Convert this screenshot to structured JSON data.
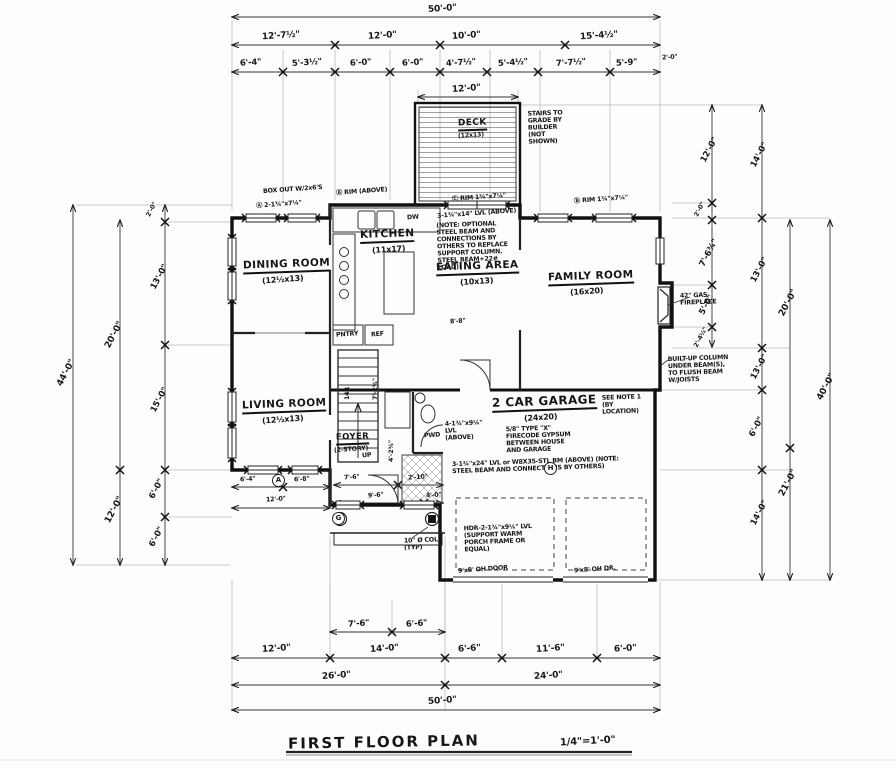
{
  "title": {
    "name": "FIRST FLOOR PLAN",
    "scale": "1/4\"=1'-0\""
  },
  "rooms": {
    "dining": {
      "name": "DINING ROOM",
      "size": "(12½x13)"
    },
    "kitchen": {
      "name": "KITCHEN",
      "size": "(11x17)"
    },
    "eating": {
      "name": "EATING AREA",
      "size": "(10x13)"
    },
    "family": {
      "name": "FAMILY ROOM",
      "size": "(16x20)"
    },
    "living": {
      "name": "LIVING ROOM",
      "size": "(12½x13)"
    },
    "foyer": {
      "name": "FOYER",
      "size": "(2-STORY)"
    },
    "garage": {
      "name": "2 CAR GARAGE",
      "size": "(24x20)"
    },
    "deck": {
      "name": "DECK",
      "size": "(12x13)"
    }
  },
  "dims": {
    "top": {
      "overall": "50'-0\"",
      "row2": [
        "12'-7½\"",
        "12'-0\"",
        "10'-0\"",
        "15'-4½\""
      ],
      "row3": [
        "6'-4\"",
        "5'-3½\"",
        "6'-0\"",
        "6'-0\"",
        "4'-7½\"",
        "5'-4½\"",
        "7'-7½\"",
        "5'-9\"",
        "2'-0\""
      ],
      "deck": "12'-0\""
    },
    "bottom": {
      "rowA": [
        "7'-6\"",
        "6'-6\""
      ],
      "rowB": [
        "12'-0\"",
        "14'-0\"",
        "6'-6\"",
        "11'-6\"",
        "6'-0\""
      ],
      "rowC": [
        "26'-0\"",
        "24'-0\""
      ],
      "overall": "50'-0\""
    },
    "left": {
      "overall": "44'-0\"",
      "mid": [
        "20'-0\"",
        "12'-0\""
      ],
      "inner": [
        "2'-0\"",
        "13'-0\"",
        "15'-0\"",
        "6'-0\"",
        "6'-0\""
      ]
    },
    "right": {
      "overall": "40'-0\"",
      "col3": [
        "20'-0\"",
        "21'-0\""
      ],
      "col2": [
        "14'-0\"",
        "13'-0\"",
        "13'-0\"",
        "6'-0\"",
        "14'-0\""
      ],
      "col1": [
        "12'-0\"",
        "2'-0\"",
        "7'-6¾\"",
        "5'-0\"",
        "2'-4½\""
      ]
    },
    "living_sub": [
      "6'-4\"",
      "6'-8\"",
      "12'-0\""
    ],
    "porch": [
      "7'-6\"",
      "2'-10\"",
      "9'-6\"",
      "4'-0\""
    ],
    "foyer_sub": [
      "8'-8\"",
      "7'-2¾\"",
      "4'-2¾\""
    ]
  },
  "notes": {
    "deck_side": "STAIRS TO GRADE BY BUILDER (NOT SHOWN)",
    "deck_rim": "Ⓒ RIM 1¾\"x7¼\"",
    "box_out": "BOX OUT W/2x6'S",
    "hdr_a": "Ⓐ 2-1¾\"x7¼\"",
    "rim_b1": "Ⓑ RIM (ABOVE)",
    "rim_b2": "Ⓑ RIM 1¾\"x7¼\"",
    "lvl_beam": "3-1¾\"x14\" LVL (ABOVE)",
    "lvl_beam_note": "(NOTE: OPTIONAL STEEL BEAM AND CONNECTIONS BY OTHERS TO REPLACE SUPPORT COLUMN. STEEL BEAM+22# LOAD)",
    "fireplace": "42\" GAS FIREPLACE",
    "built_up": "BUILT-UP COLUMN UNDER BEAM(S), TO FLUSH BEAM W/JOISTS",
    "see_note": "SEE NOTE 1 (BY LOCATION)",
    "gypsum": "5/8\" TYPE \"X\" FIRECODE GYPSUM BETWEEN HOUSE AND GARAGE",
    "lvl_above": "4-1¾\"x9¼\" LVL (ABOVE)",
    "steel_bm": "3-1¾\"x24\" LVL or W8X35-STL BM (ABOVE) (NOTE: STEEL BEAM AND CONNECTIONS BY OTHERS)",
    "hdr_porch": "HDR-2-1¾\"x9¼\" LVL (SUPPORT WARM PORCH FRAME OR EQUAL)",
    "col_typ": "10\" Ø COL (TYP)",
    "door_left": "9'x8' OH DOOR",
    "door_right": "9'x8' OH DR.",
    "risers": "14R",
    "up": "UP",
    "pntry": "PNTRY",
    "ref": "REF",
    "dw": "DW",
    "pwd": "PWD",
    "marker_a": "A",
    "marker_g": "G",
    "marker_h": "H"
  }
}
